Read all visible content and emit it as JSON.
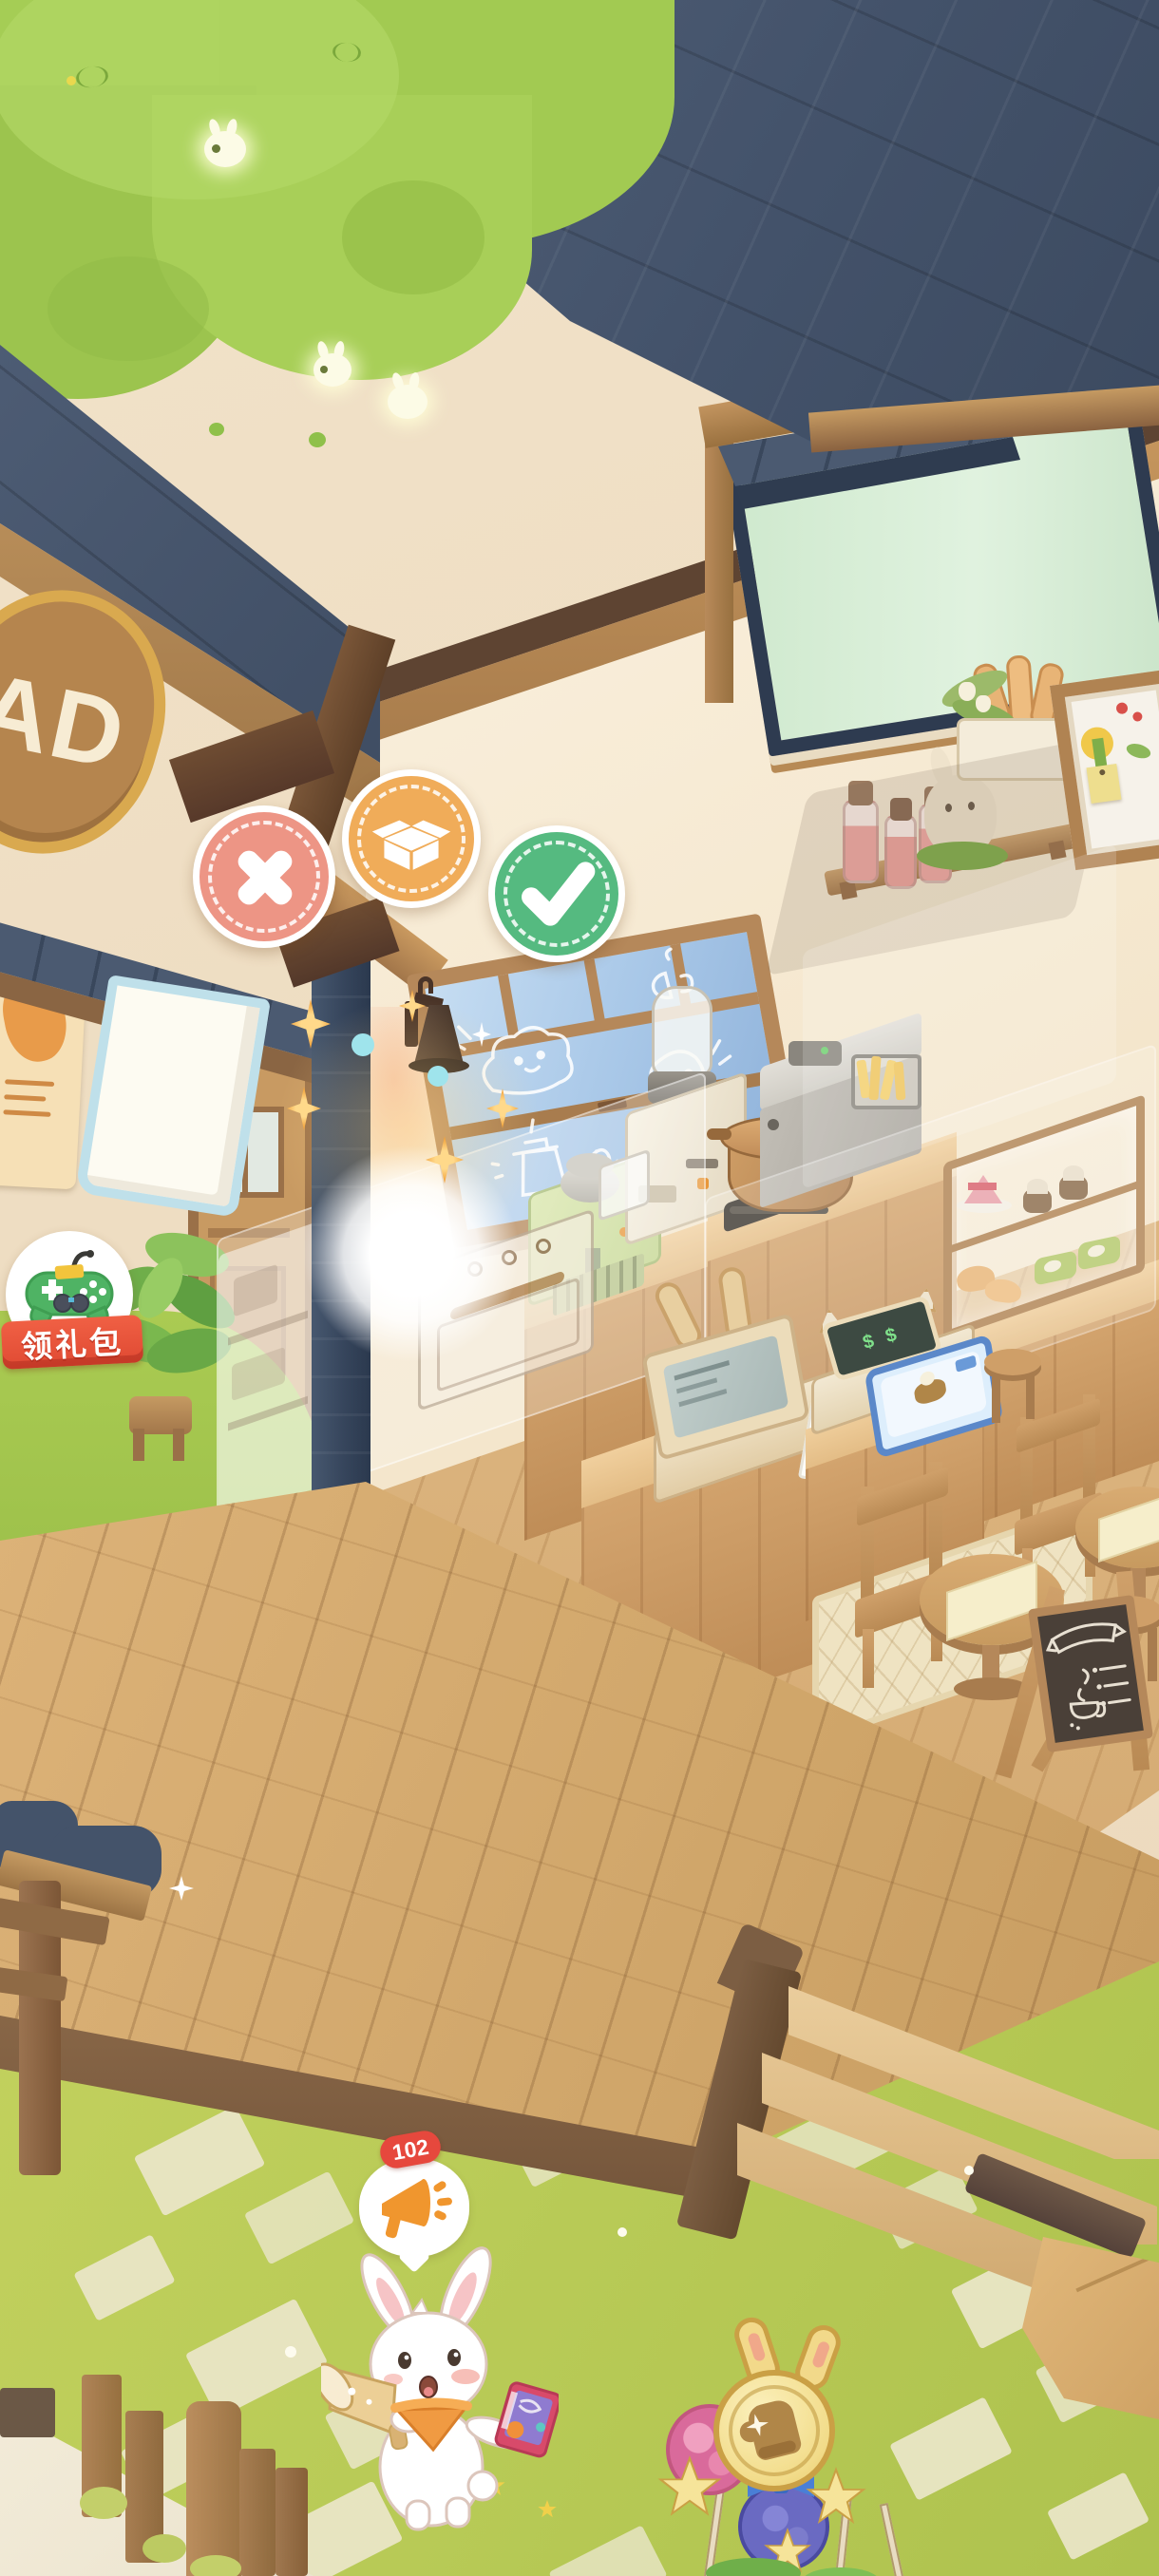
{
  "ui": {
    "edit_toolbar": {
      "cancel": {
        "icon": "x-icon",
        "color": "#ED9585"
      },
      "store": {
        "icon": "box-icon",
        "color": "#F0AC59"
      },
      "confirm": {
        "icon": "check-icon",
        "color": "#55BA80"
      }
    },
    "gift_button": {
      "label": "领礼包",
      "icon": "gamepad-icon",
      "banner_color": "#EB5740"
    },
    "announcement": {
      "badge_count": "102",
      "icon": "megaphone-icon",
      "badge_color": "#E6483D"
    }
  },
  "scene": {
    "shop_sign": {
      "text": "AD",
      "color": "#B5854E"
    },
    "serving_screen_text": "$ $",
    "objects": [
      "tree-canopy",
      "slate-roof",
      "transom-window",
      "shop-sign",
      "entrance-awning",
      "noren-curtain",
      "bread-poster",
      "shop-door",
      "wall-lamp",
      "doodle-window",
      "wall-shelf",
      "juice-bottles",
      "bunny-figurine",
      "bread-basket",
      "picture-frame",
      "sticky-note",
      "espresso-machine",
      "coffee-grinder",
      "pot-stove",
      "deep-fryer",
      "oven",
      "pastry-display-case",
      "cash-register",
      "serving-station",
      "cafe-table",
      "cafe-chair",
      "stool",
      "rug",
      "menu-chalkboard",
      "pillar",
      "wood-deck",
      "deck-steps",
      "grass",
      "stone-path",
      "garden-fence",
      "wood-gate",
      "potted-plant",
      "announcer-rabbit",
      "speech-bubble",
      "candy-decor",
      "cardboard-box",
      "fireflies",
      "sparkles",
      "tap-glow"
    ]
  },
  "palette": {
    "canopy_green": "#A5CD55",
    "roof_slate": "#49586E",
    "wall_beige": "#EFDFC6",
    "interior_cream": "#F8EDDA",
    "wood_trim": "#C89A62",
    "pillar_navy": "#394A63",
    "window_blue": "#A9C8E8",
    "transom_mint": "#D4EAD2",
    "deck_wood": "#D2A96E",
    "grass_green": "#B9CB57",
    "path_stone": "#EAE6C9",
    "bandana_orange": "#F09A42"
  }
}
